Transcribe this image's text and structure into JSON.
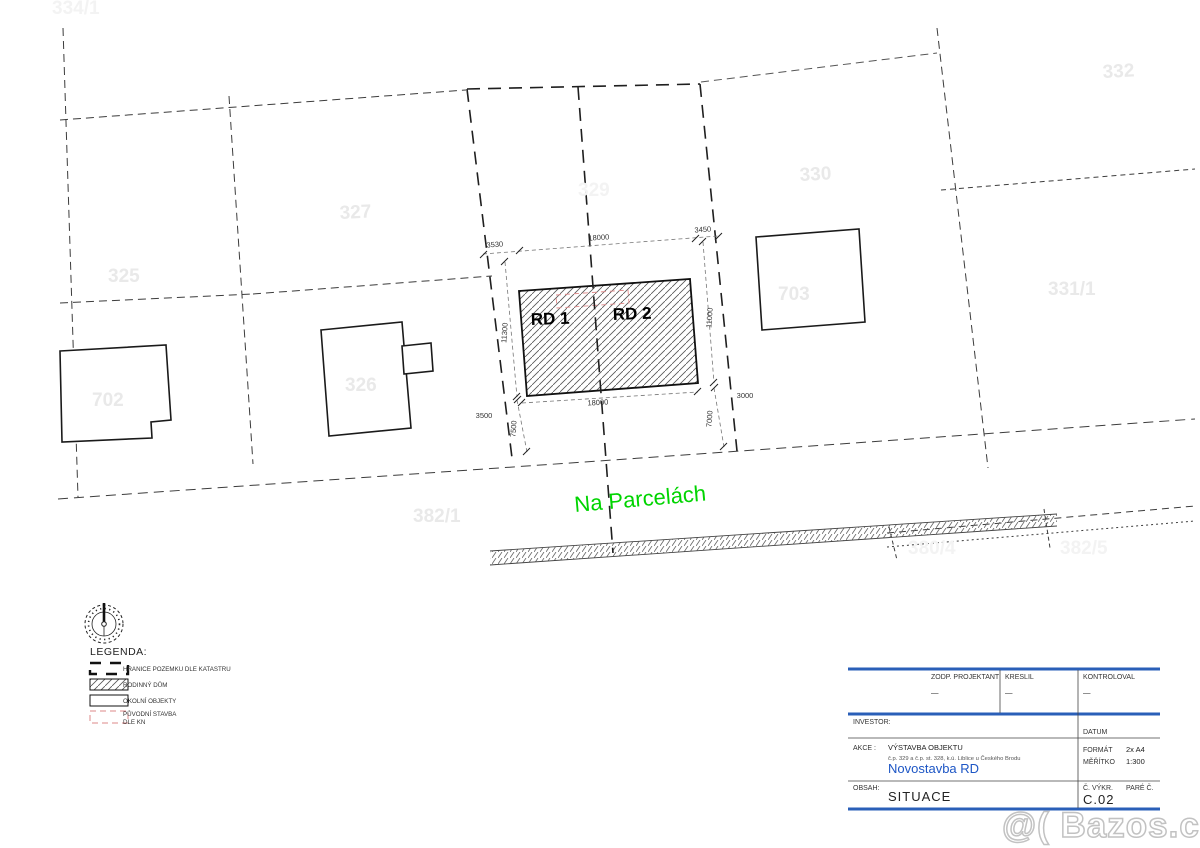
{
  "drawing": {
    "rd1_label": "RD 1",
    "rd2_label": "RD 2",
    "street_name": "Na Parcelách",
    "street_color": "#00d400"
  },
  "parcels": [
    {
      "label": "334/1"
    },
    {
      "label": "332"
    },
    {
      "label": "330"
    },
    {
      "label": "327"
    },
    {
      "label": "325"
    },
    {
      "label": "329"
    },
    {
      "label": "326"
    },
    {
      "label": "702"
    },
    {
      "label": "703"
    },
    {
      "label": "331/1"
    },
    {
      "label": "382/1"
    },
    {
      "label": "380/4"
    },
    {
      "label": "382/5"
    }
  ],
  "dimensions": {
    "top_left": "3530",
    "top_mid": "18000",
    "top_right": "3450",
    "left_height": "11300",
    "right_height": "11000",
    "bottom_width": "18000",
    "left_offset": "3500",
    "left_front": "7500",
    "right_front": "7000",
    "right_offset": "3000"
  },
  "legend": {
    "title": "LEGENDA:",
    "items": [
      {
        "label": "HRANICE POZEMKU DLE KATASTRU"
      },
      {
        "label": "RODINNÝ DŮM"
      },
      {
        "label": "OKOLNÍ OBJEKTY"
      },
      {
        "label": "PŮVODNÍ STAVBA",
        "label2": "DLE KN"
      }
    ],
    "original_color": "#dd8888"
  },
  "titleblock": {
    "accent": "#2a5fb8",
    "zodp_projektant": "ZODP. PROJEKTANT",
    "kreslil": "KRESLIL",
    "kontroloval": "KONTROLOVAL",
    "dash1": "—",
    "dash2": "—",
    "dash3": "—",
    "investor": "INVESTOR:",
    "datum": "DATUM",
    "akce": "AKCE :",
    "akce_value": "VÝSTAVBA OBJEKTU",
    "akce_detail": "č.p. 329 a č.p. st. 328, k.ú. Liblice u Českého Brodu",
    "project_name": "Novostavba RD",
    "project_color": "#1d56c5",
    "format_label": "FORMÁT",
    "format_value": "2x A4",
    "meritko_label": "MĚŘÍTKO",
    "meritko_value": "1:300",
    "obsah_label": "OBSAH:",
    "obsah_value": "SITUACE",
    "cvykr_label": "Č. VÝKR.",
    "pare_label": "PARÉ Č.",
    "cvykr_value": "C.02"
  },
  "watermark": "@( Bazos.cz"
}
